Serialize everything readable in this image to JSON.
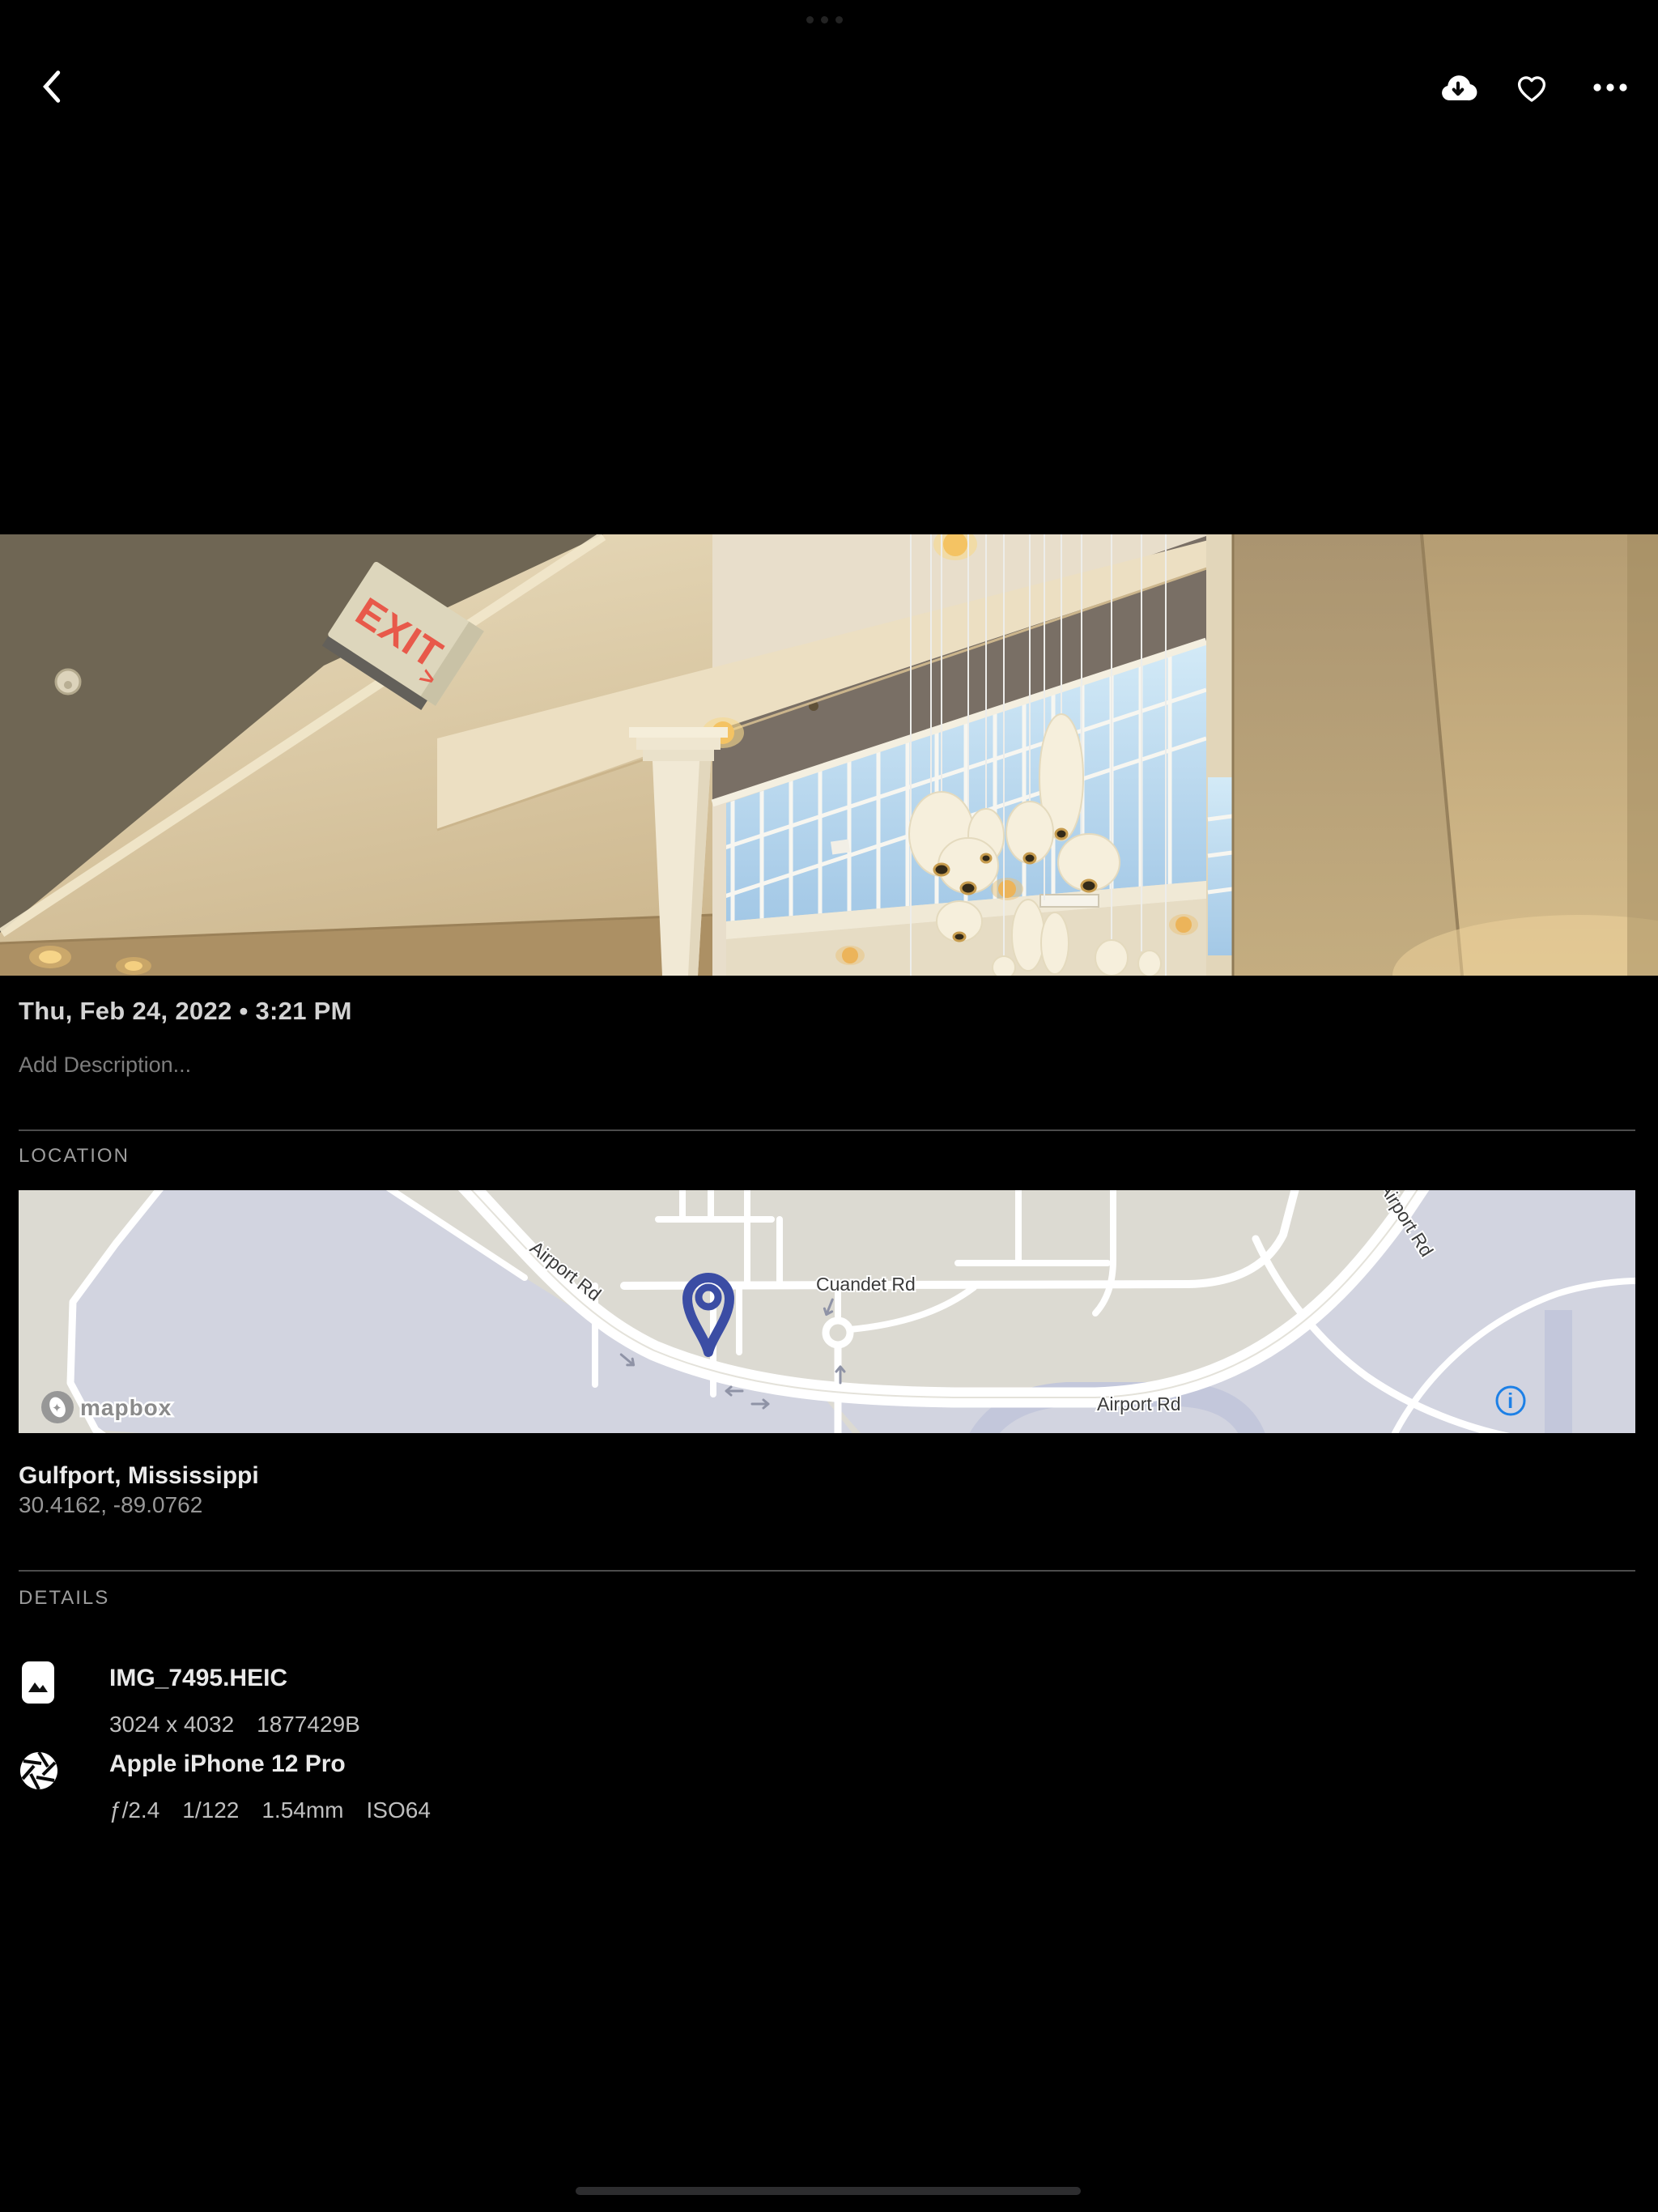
{
  "topbar": {
    "back_icon": "chevron-left",
    "actions": [
      "cloud-download",
      "heart",
      "ellipsis"
    ]
  },
  "photo": {
    "datetime": "Thu, Feb 24, 2022 • 3:21 PM",
    "description_placeholder": "Add Description...",
    "exit_sign": "EXIT",
    "exit_arrow": ">"
  },
  "location": {
    "header": "LOCATION",
    "place": "Gulfport, Mississippi",
    "coordinates": "30.4162, -89.0762",
    "map": {
      "label_airport_diagonal": "Airport Rd",
      "label_cuandet": "Cuandet Rd",
      "label_airport_bottom": "Airport Rd",
      "label_airport_right": "Airport Rd",
      "attribution": "mapbox",
      "info_glyph": "i"
    }
  },
  "details": {
    "header": "DETAILS",
    "file": {
      "name": "IMG_7495.HEIC",
      "dimensions": "3024 x 4032",
      "size": "1877429B"
    },
    "camera": {
      "name": "Apple iPhone 12 Pro",
      "aperture": "ƒ/2.4",
      "shutter": "1/122",
      "focal": "1.54mm",
      "iso": "ISO64"
    }
  },
  "colors": {
    "pin_blue": "#3b4da4",
    "info_blue": "#1d80e6",
    "exit_red": "#e8594a",
    "map_land": "#dcdad2",
    "map_zone": "#d2d4e0",
    "sky": "#b9d9ef"
  }
}
